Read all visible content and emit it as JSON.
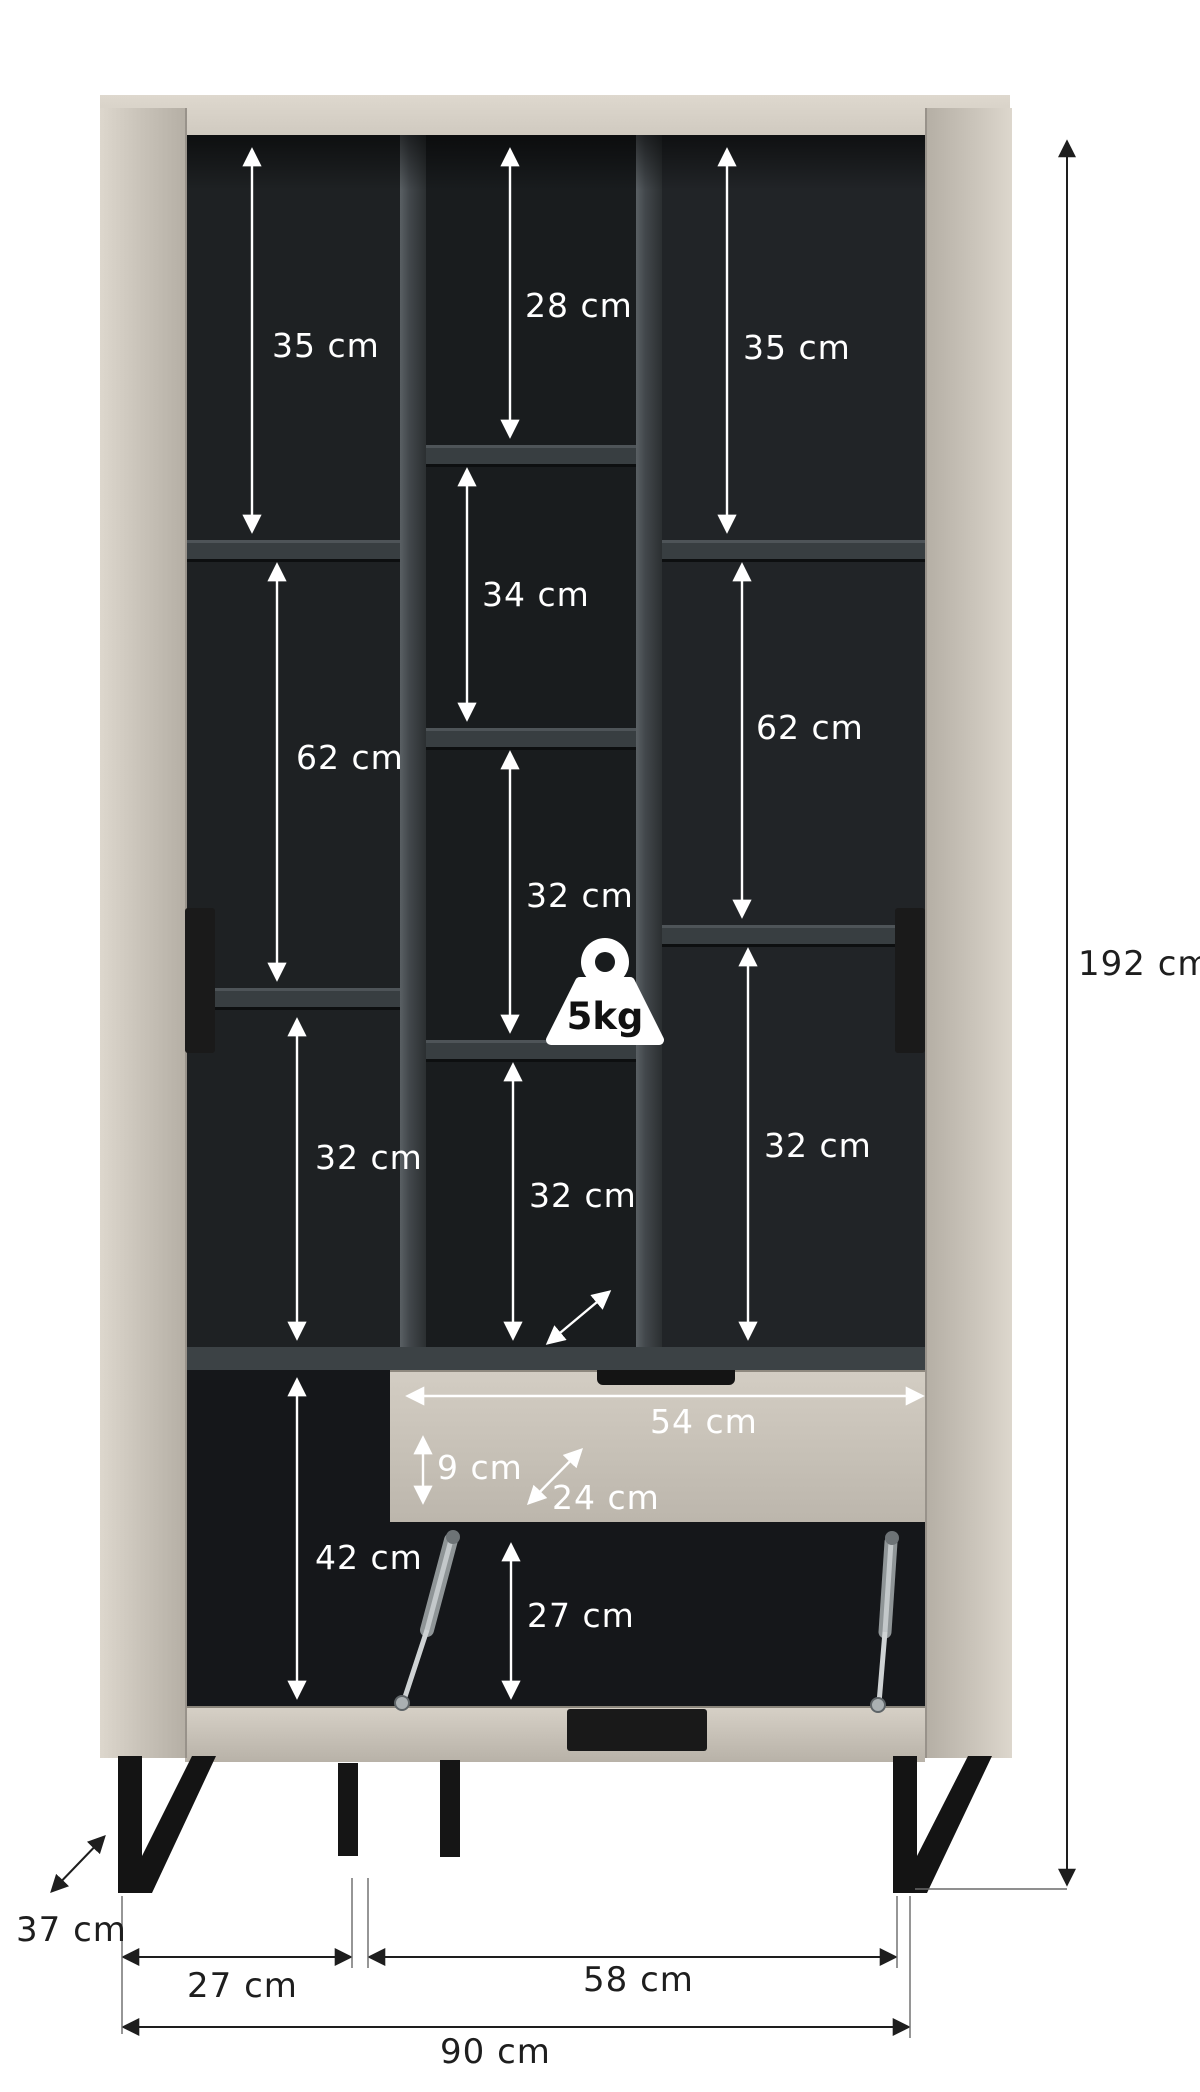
{
  "diagram": {
    "kind": "furniture dimension diagram",
    "item": "tall cabinet with open doors, shelves, drawer and drop-down flap",
    "units": "cm",
    "overall": {
      "height": "192 cm",
      "width": "90 cm",
      "depth": "37 cm"
    },
    "columns": {
      "left": {
        "sections": [
          "35 cm",
          "62 cm",
          "32 cm",
          "42 cm"
        ]
      },
      "middle": {
        "sections": [
          "28 cm",
          "34 cm",
          "32 cm",
          "32 cm"
        ]
      },
      "right": {
        "sections": [
          "35 cm",
          "62 cm",
          "32 cm"
        ]
      }
    },
    "drawer": {
      "width": "54 cm",
      "inner_height": "9 cm",
      "inner_depth": "24 cm"
    },
    "flap_compartment": {
      "height": "27 cm"
    },
    "bottom": {
      "left_section_width": "27 cm",
      "right_section_width": "58 cm",
      "total_width": "90 cm"
    },
    "shelf_max_load": "5kg",
    "colors": {
      "body": "#c9c3b9",
      "top": "#d7d1c7",
      "interior": "#1b1d1f",
      "shelf": "#383e41",
      "legs": "#141414",
      "dimension_light": "#ffffff",
      "dimension_dark": "#1e1e1e",
      "background": "#ffffff"
    }
  }
}
